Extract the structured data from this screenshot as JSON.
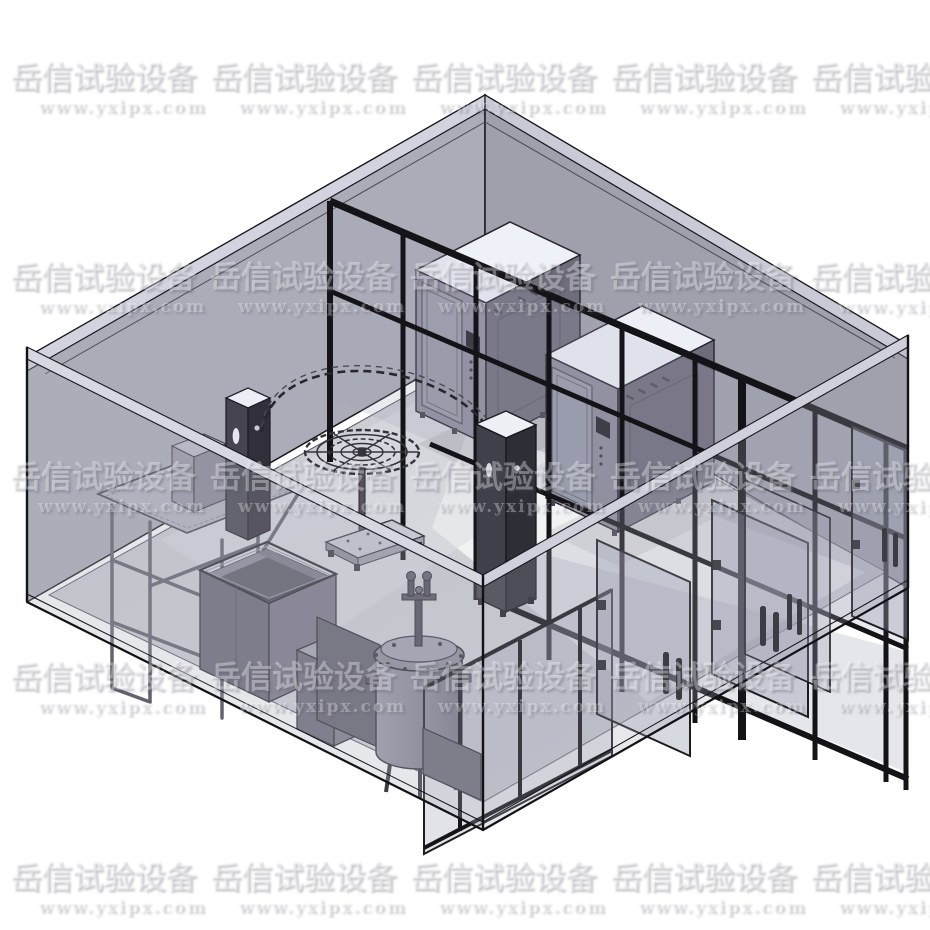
{
  "watermark": {
    "brand": "岳信试验设备",
    "url": "www.yxipx.com",
    "tile_width": 200,
    "tile_height": 200,
    "col_origins": [
      10,
      210,
      410,
      610,
      810
    ],
    "row_origins": [
      62,
      262,
      462,
      662,
      862
    ]
  },
  "palette": {
    "background": "#ffffff",
    "wall_back_left": "#abacb8",
    "wall_back_right": "#9fa0ac",
    "wall_top_band": "#d2d3de",
    "floor": "#cbccd3",
    "floor_bright": "#f2f3f6",
    "frame_black": "#17171c",
    "glass_tint": "rgba(160,165,186,0.24)",
    "chamber_top": "#eff1f8",
    "chamber_face_light": "#908e9f",
    "chamber_face_dark": "#6f6d7c",
    "equipment_gray": "#6d6a79",
    "pillar_dark": "#3d3c46",
    "strut_gray": "#63626e"
  },
  "scene": {
    "room": "translucent-walled laboratory room, open top, isometric view",
    "objects": [
      "glass-partition-enclosure",
      "test-chamber-1",
      "test-chamber-2",
      "rain-spray-arc-tube",
      "rotating-sample-table",
      "spray-control-pillar",
      "drip-control-pillar",
      "drip-test-stand",
      "immersion-tank",
      "small-cabinet",
      "pressure-vessel",
      "glass-doors-with-handles"
    ]
  }
}
